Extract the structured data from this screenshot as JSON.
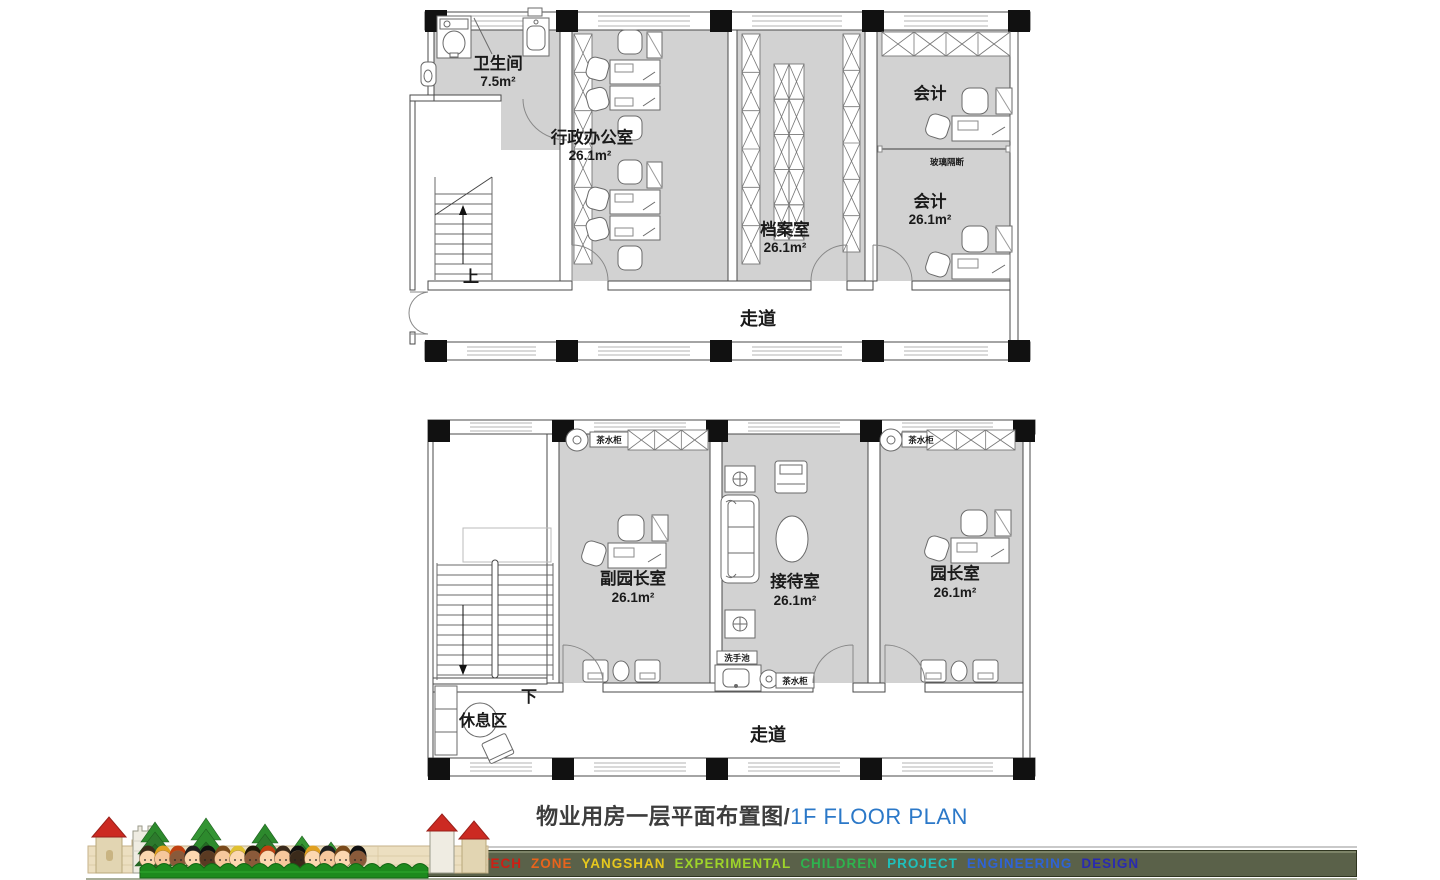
{
  "title": {
    "cn": "物业用房一层平面布置图/",
    "en": "1F FLOOR PLAN"
  },
  "plans": {
    "upper": {
      "rooms": [
        {
          "name": "卫生间",
          "area": "7.5m²"
        },
        {
          "name": "行政办公室",
          "area": "26.1m²"
        },
        {
          "name": "档案室",
          "area": "26.1m²"
        },
        {
          "name": "会计",
          "area": ""
        },
        {
          "name": "会计",
          "area": "26.1m²"
        }
      ],
      "corridor": "走道",
      "stair": "上",
      "partition": "玻璃隔断"
    },
    "lower": {
      "rooms": [
        {
          "name": "副园长室",
          "area": "26.1m²"
        },
        {
          "name": "接待室",
          "area": "26.1m²"
        },
        {
          "name": "园长室",
          "area": "26.1m²"
        }
      ],
      "corridor": "走道",
      "stair": "下",
      "rest_area": "休息区",
      "tea_cabinet": "茶水柜",
      "wash_basin": "洗手池"
    }
  },
  "footer": {
    "banner_words": [
      {
        "text": "HIGH-TECH",
        "color": "#cc1f14"
      },
      {
        "text": "ZONE",
        "color": "#e8641c"
      },
      {
        "text": "YANGSHAN",
        "color": "#e6c81e"
      },
      {
        "text": "EXPERIMENTAL",
        "color": "#9ed42a"
      },
      {
        "text": "CHILDREN",
        "color": "#2eb34e"
      },
      {
        "text": "PROJECT",
        "color": "#1fc0bb"
      },
      {
        "text": "ENGINEERING",
        "color": "#2f63d4"
      },
      {
        "text": "DESIGN",
        "color": "#2a2bb0"
      }
    ]
  },
  "colors": {
    "room_fill": "#d2d2d2",
    "accent_blue": "#2b78c8",
    "banner_bg": "#5a6149"
  }
}
